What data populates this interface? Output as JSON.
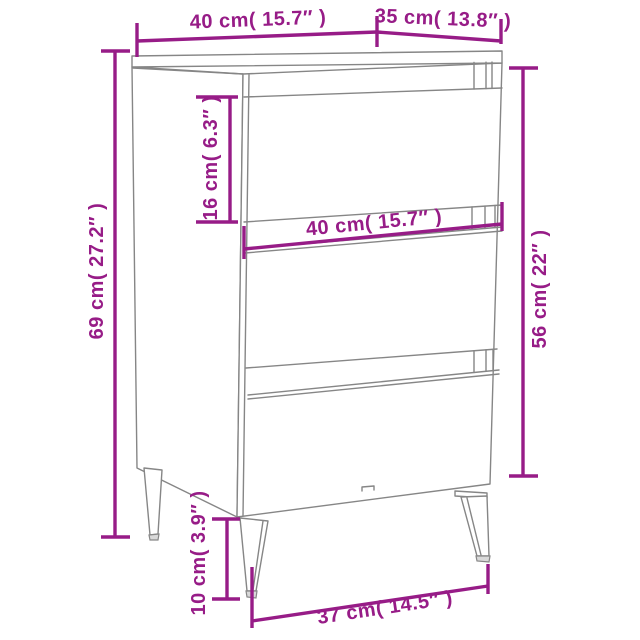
{
  "image": {
    "type": "product-dimension-diagram",
    "subject": "three-drawer nightstand cabinet with tapered metal legs",
    "background": "#ffffff"
  },
  "colors": {
    "dimension_accent": "#971c87",
    "line_art": "#868686"
  },
  "dimensions": {
    "top_width": {
      "label": "40 cm( 15.7″ )",
      "cm": 40,
      "inches": 15.7
    },
    "top_depth": {
      "label": "35 cm( 13.8″ )",
      "cm": 35,
      "inches": 13.8
    },
    "total_height": {
      "label": "69 cm( 27.2″ )",
      "cm": 69,
      "inches": 27.2
    },
    "top_drawer_height": {
      "label": "16 cm( 6.3″ )",
      "cm": 16,
      "inches": 6.3
    },
    "front_width": {
      "label": "40 cm( 15.7″ )",
      "cm": 40,
      "inches": 15.7
    },
    "body_height": {
      "label": "56 cm( 22″ )",
      "cm": 56,
      "inches": 22
    },
    "leg_height": {
      "label": "10 cm( 3.9″ )",
      "cm": 10,
      "inches": 3.9
    },
    "leg_span": {
      "label": "37 cm( 14.5″ )",
      "cm": 37,
      "inches": 14.5
    }
  }
}
